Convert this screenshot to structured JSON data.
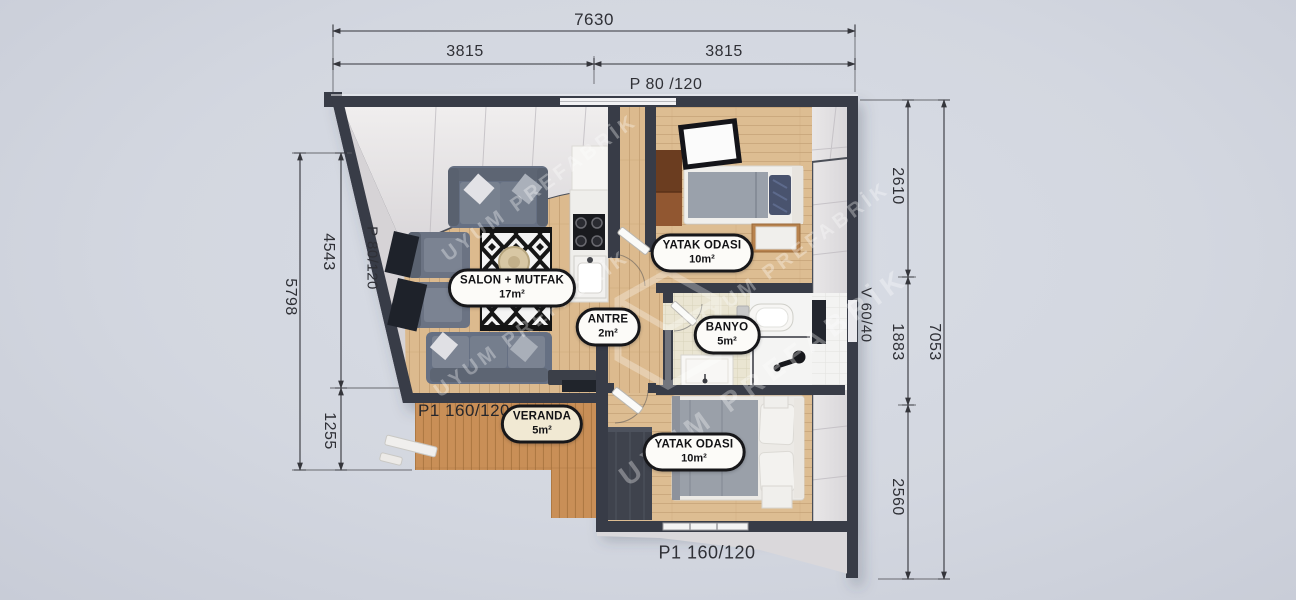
{
  "watermark": {
    "text": "UYUM PREFABRİK"
  },
  "rooms": {
    "salon": {
      "name": "SALON + MUTFAK",
      "area": "17m²"
    },
    "antre": {
      "name": "ANTRE",
      "area": "2m²"
    },
    "yatak1": {
      "name": "YATAK ODASI",
      "area": "10m²"
    },
    "banyo": {
      "name": "BANYO",
      "area": "5m²"
    },
    "yatak2": {
      "name": "YATAK ODASI",
      "area": "10m²"
    },
    "veranda": {
      "name": "VERANDA",
      "area": "5m²"
    }
  },
  "dimensions": {
    "top": {
      "total": "7630",
      "left_half": "3815",
      "right_half": "3815",
      "window": "P 80 /120"
    },
    "left": {
      "total": "5798",
      "upper": "4543",
      "lower": "1255",
      "window": "P 80/120"
    },
    "right": {
      "total": "7053",
      "top": "2610",
      "middle": "1883",
      "bottom": "2560",
      "window": "V 60/40"
    },
    "bottom": {
      "door": "P1 160/120"
    },
    "veranda": {
      "door": "P1 160/120"
    }
  },
  "colors": {
    "background": "#d3d7e0",
    "wall": "#383c47",
    "wood_floor": "#dcba8e",
    "deck_wood": "#c98f57",
    "bath_tile": "#eae5d2",
    "sofa_gray": "#667083",
    "pill_bg": "#fcfbf8",
    "pill_border": "#17171a",
    "dim_text": "#2f3036"
  }
}
